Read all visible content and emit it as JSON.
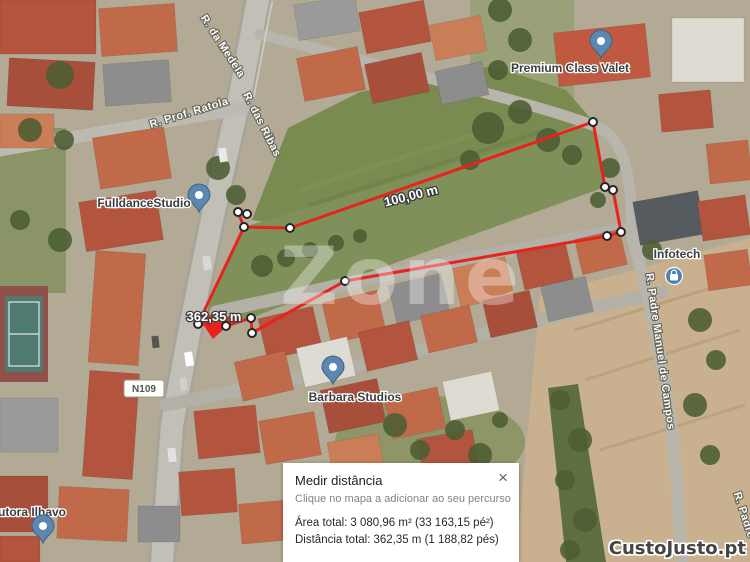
{
  "colors": {
    "measure_line": "#e8231d",
    "pin_blue": "#5b87b0",
    "grass": "#7a8b51",
    "field_tan": "#c9b18f",
    "road_gray": "#c2bfb7"
  },
  "map": {
    "street_labels": [
      {
        "id": "medela",
        "text": "R. da Medela"
      },
      {
        "id": "ratola",
        "text": "R. Prof. Ratola"
      },
      {
        "id": "ribas",
        "text": "R. das Ribas"
      },
      {
        "id": "padre-manuel",
        "text": "R. Padre Manuel de Campos"
      },
      {
        "id": "padre-partial",
        "text": "R. Padre"
      }
    ],
    "road_badge": "N109",
    "pois": [
      {
        "name": "Premium Class Valet"
      },
      {
        "name": "FulldanceStudio"
      },
      {
        "name": "Infotech"
      },
      {
        "name": "Barbara Studios"
      },
      {
        "name": "utora Ilhavo"
      }
    ],
    "measure_labels": [
      {
        "text": "100,00 m"
      },
      {
        "text": "362,35 m"
      }
    ]
  },
  "panel": {
    "title": "Medir distância",
    "hint": "Clique no mapa a adicionar ao seu percurso",
    "area_label": "Área total:",
    "area_value": "3 080,96 m² (33 163,15 pé²)",
    "distance_label": "Distância total:",
    "distance_value": "362,35 m (1 188,82 pés)",
    "close": "×"
  },
  "watermarks": {
    "center": "Zone",
    "brand": "CustoJusto.pt"
  }
}
